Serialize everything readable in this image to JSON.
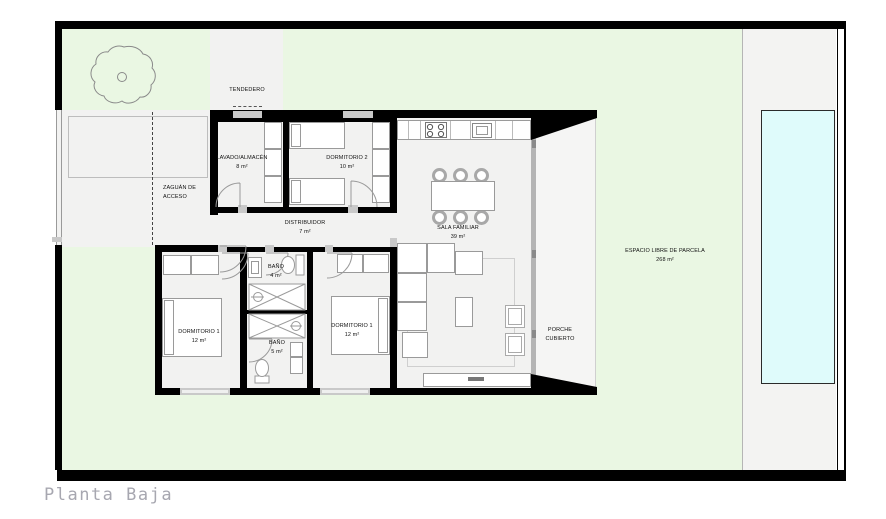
{
  "title": "Planta Baja",
  "rooms": {
    "tendedero": {
      "name": "TENDEDERO"
    },
    "lavado": {
      "name": "LAVADO/ALMACÉN",
      "area": "8 m²"
    },
    "dormitorio2": {
      "name": "DORMITORIO 2",
      "area": "10 m²"
    },
    "distribuidor": {
      "name": "DISTRIBUIDOR",
      "area": "7 m²"
    },
    "sala": {
      "name": "SALA FAMILIAR",
      "area": "39 m²"
    },
    "zaguan": {
      "line1": "ZAGUÁN DE",
      "line2": "ACCESO"
    },
    "bano1": {
      "name": "BAÑO",
      "area": "4 m²"
    },
    "bano2": {
      "name": "BAÑO",
      "area": "5 m²"
    },
    "dormitorio1a": {
      "name": "DORMITORIO 1",
      "area": "12 m²"
    },
    "dormitorio1b": {
      "name": "DORMITORIO 1",
      "area": "12 m²"
    },
    "porche": {
      "line1": "PORCHE",
      "line2": "CUBIERTO"
    },
    "parcela": {
      "name": "ESPACIO LIBRE DE PARCELA",
      "area": "268 m²"
    }
  },
  "colors": {
    "wall": "#000000",
    "garden": "#eaf7e3",
    "floor": "#f2f2f1",
    "porch": "#f5f5f4",
    "pool": "#dffbfb",
    "outline": "#9a9a9a",
    "title": "#a7a7b0"
  }
}
